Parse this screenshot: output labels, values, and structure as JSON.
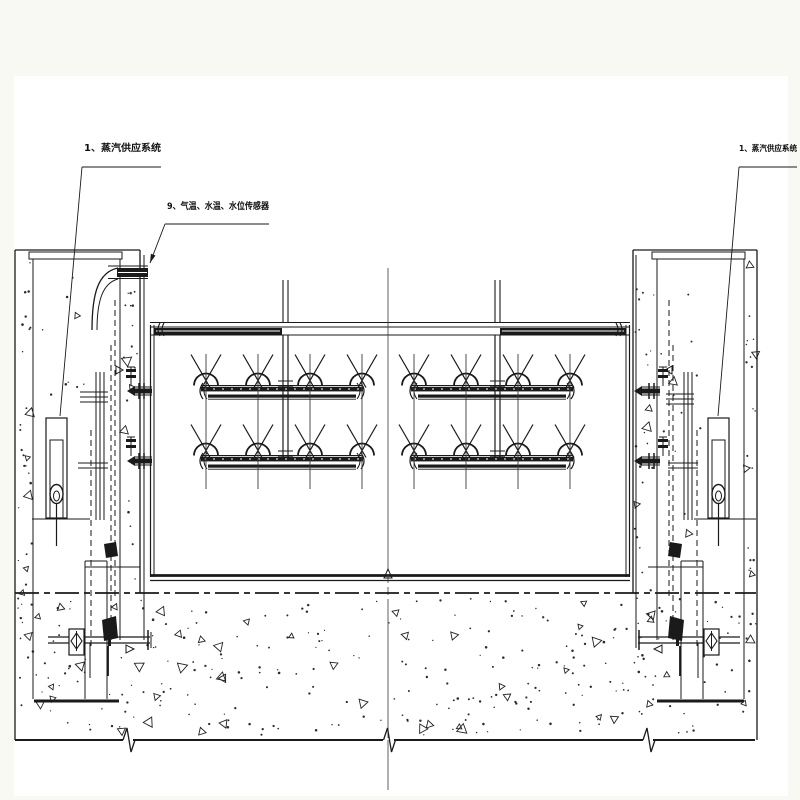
{
  "page": {
    "background": "#f7f9f2",
    "paper": "#ffffff",
    "ink": "#1a1a1a",
    "thin_line": "#3a3a3a"
  },
  "annotations": {
    "steam_supply_left": "1、蒸汽供应系统",
    "sensors": "9、气温、水温、水位传感器",
    "steam_supply_right": "1、蒸汽供应系统"
  },
  "drawing": {
    "type": "engineering-elevation-diagram",
    "panels": 2,
    "nozzle_rows": 2,
    "nozzles_per_row_per_panel": 4,
    "row_y": [
      390,
      460
    ],
    "nozzle_x_left": [
      206,
      258,
      310,
      362
    ],
    "nozzle_x_right": [
      414,
      466,
      518,
      570
    ],
    "pipe_span_left": [
      196,
      368
    ],
    "pipe_span_right": [
      406,
      578
    ],
    "centerline_x": 388
  }
}
